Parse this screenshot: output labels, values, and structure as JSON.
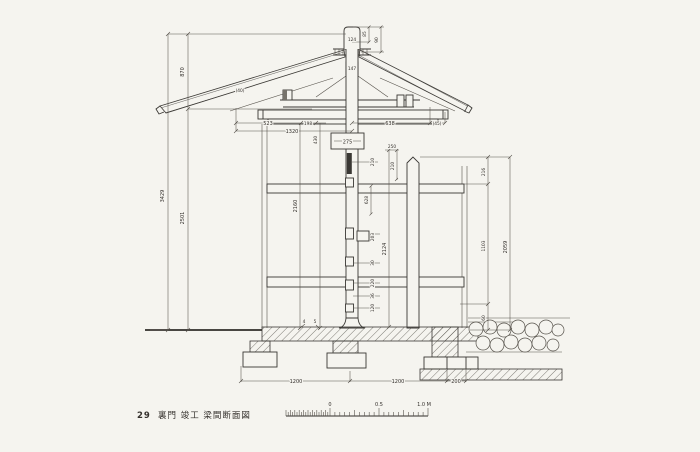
{
  "colors": {
    "paper": "#f5f4ef",
    "ink": "#3a3834",
    "dim_line": "#57534c"
  },
  "caption": {
    "number": "29",
    "title": "裏門 竣工 梁間断面図"
  },
  "scale_bar": {
    "zero": "0",
    "half": "0.5",
    "one": "1.0 M"
  },
  "dims": {
    "left_total": "3429",
    "left_upper": "870",
    "left_lower": "2501",
    "mid_total": "2160",
    "kabuki_v": "430",
    "eave_l1": "523",
    "eave_l2": "198",
    "eave_l3": "1320",
    "eave_note": "(40)",
    "eave_r1": "638",
    "eave_r2": "(45)",
    "cap_w": "124",
    "cap_h1": "85",
    "cap_h2": "90",
    "ridge_beam": "147",
    "col_w": "275",
    "col_n1": "250",
    "col_n2": "210",
    "col_d1": "210",
    "col_d2": "628",
    "col_d3": "203",
    "col_d4": "30",
    "col_d5": "220",
    "col_d6": "36",
    "col_d7": "120",
    "col_total": "2124",
    "right_s1": "216",
    "right_s2": "1103",
    "right_s3": "60",
    "right_total": "2059",
    "base_l": "1200",
    "base_r": "1200",
    "base_e": "200",
    "mark_a": "4",
    "mark_b": "5"
  }
}
